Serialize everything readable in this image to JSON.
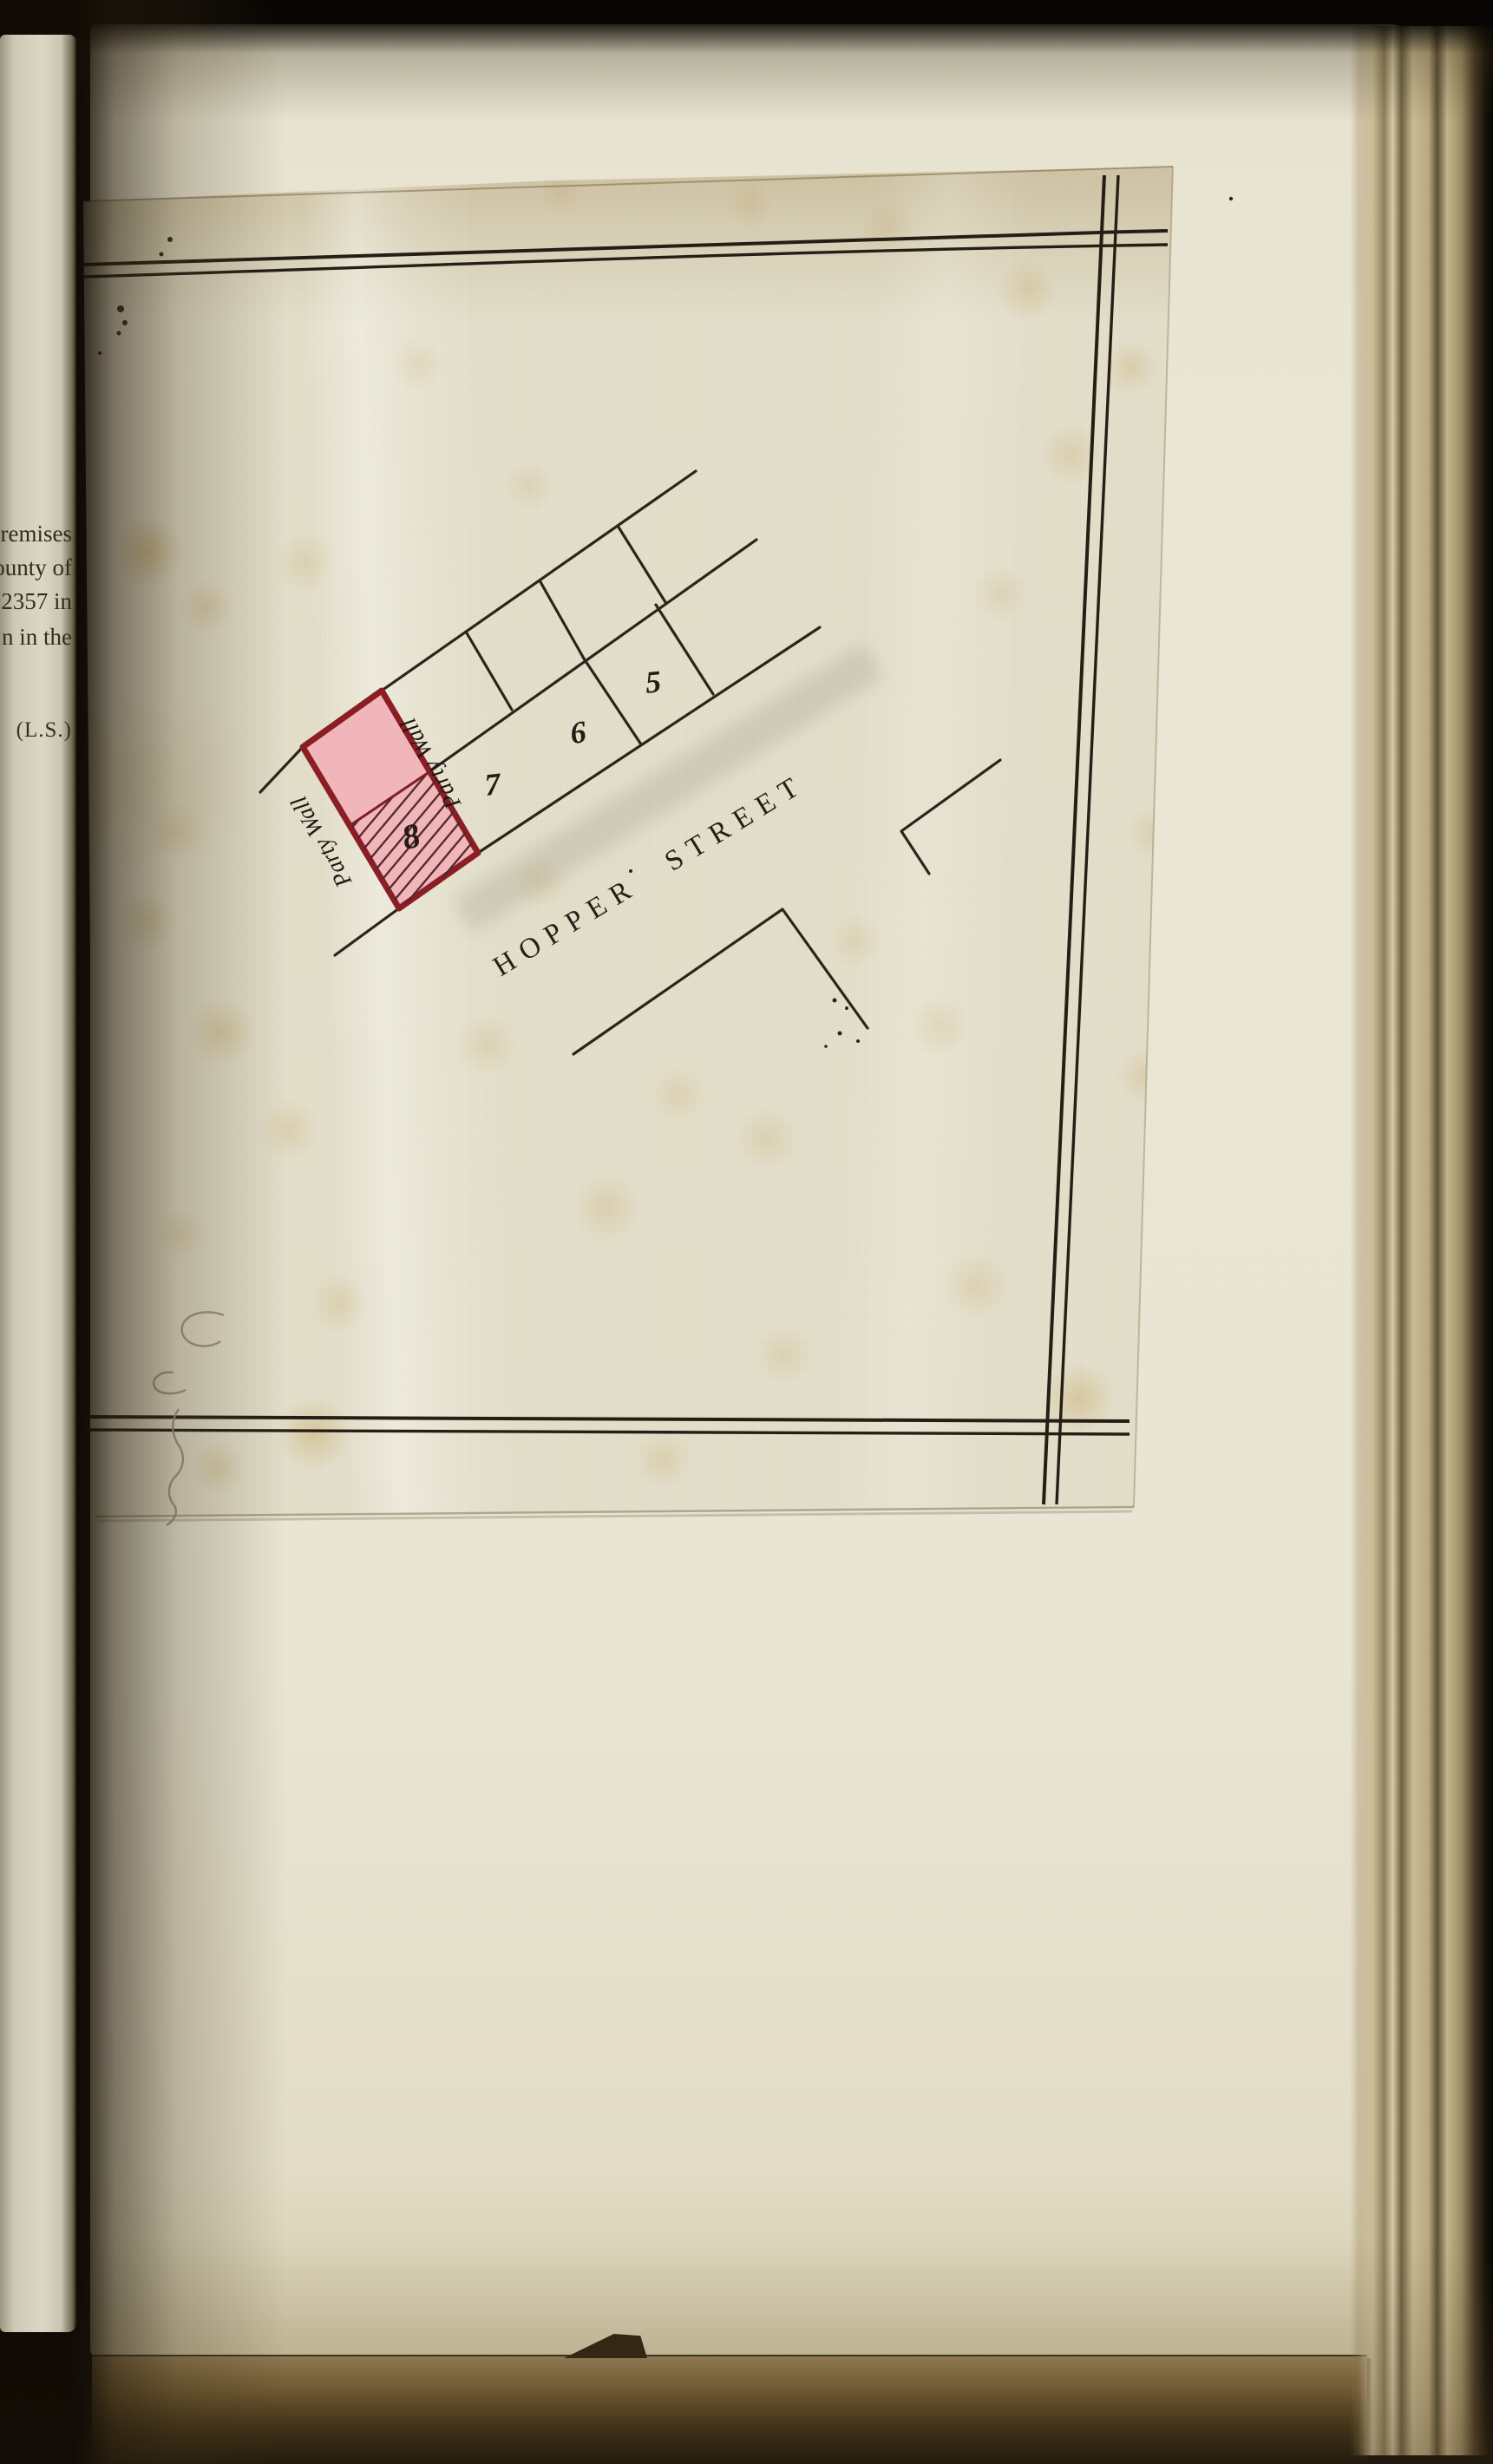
{
  "document": {
    "left_page_fragments": [
      "premises",
      "ounty of",
      "2357 in",
      "n in the"
    ],
    "seal_mark": "(L.S.)"
  },
  "plan": {
    "street": {
      "word1": "HOPPER",
      "word2": "STREET"
    },
    "plots": {
      "p5": "5",
      "p6": "6",
      "p7": "7",
      "p8": "8"
    },
    "labels": {
      "party_wall_left": "Party Wall",
      "party_wall_right": "Party Wall"
    },
    "colors": {
      "ink": "#2b241b",
      "plot_outline": "#8b1e24",
      "plot_fill": "#f1b6ba",
      "hatch": "#50262a",
      "sheet": "#e3deca",
      "page": "#e9e5d4"
    }
  }
}
